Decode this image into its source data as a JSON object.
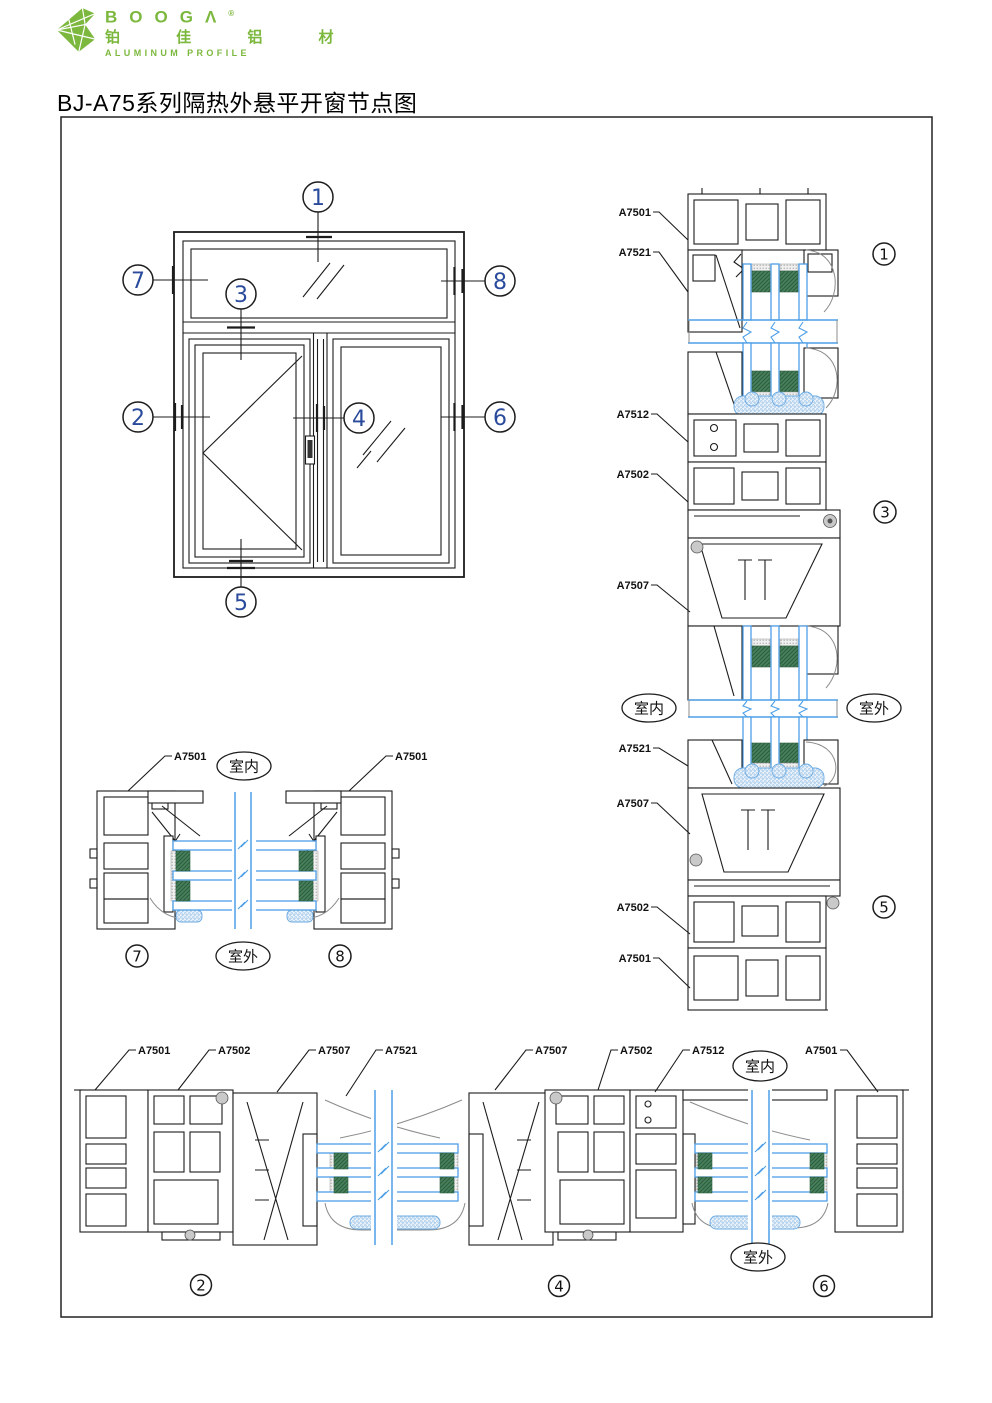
{
  "header": {
    "brand": "BOOGΛ",
    "registered": "®",
    "brand_cn": "铂 佳 铝 材",
    "tagline": "ALUMINUM PROFILE",
    "title": "BJ-A75系列隔热外悬平开窗节点图"
  },
  "terms": {
    "indoor": "室内",
    "outdoor": "室外"
  },
  "elevation": {
    "callouts": [
      "1",
      "2",
      "3",
      "4",
      "5",
      "6",
      "7",
      "8"
    ]
  },
  "vertical_section": {
    "labels": [
      "A7501",
      "A7521",
      "A7512",
      "A7502",
      "A7507",
      "A7521",
      "A7507",
      "A7502",
      "A7501"
    ],
    "details": [
      "1",
      "3",
      "5"
    ]
  },
  "jamb_section": {
    "labels": [
      "A7501",
      "A7501"
    ],
    "details": [
      "7",
      "8"
    ]
  },
  "sill_plan_section": {
    "labels": [
      "A7501",
      "A7502",
      "A7507",
      "A7521",
      "A7507",
      "A7502",
      "A7512",
      "A7501"
    ],
    "details": [
      "2",
      "4",
      "6"
    ]
  },
  "colors": {
    "brand_green": "#7cb83e",
    "glass_blue": "#4d9fe8",
    "spacer_green": "#3f7b53",
    "callout_navy": "#2a4a9c",
    "line_black": "#1c1c1c"
  }
}
